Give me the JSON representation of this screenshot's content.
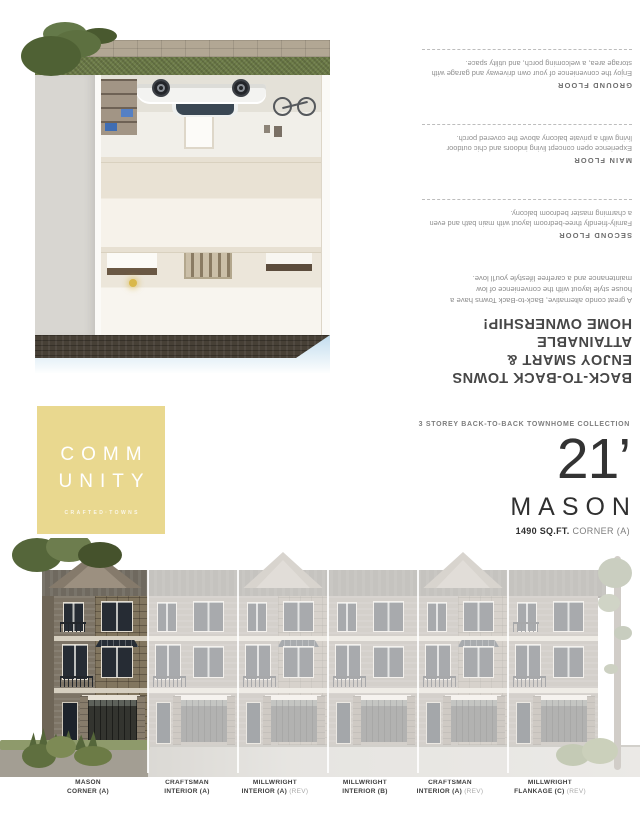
{
  "brochure": {
    "headline_lines": [
      "BACK-TO-BACK TOWNS",
      "ENJOY SMART & ATTAINABLE",
      "HOME OWNERSHIP!"
    ],
    "intro": "A great condo alternative, Back-to-Back Towns have a house style layout with the convenience of low maintenance and a carefree lifestyle you'll love.",
    "floors": [
      {
        "label": "SECOND FLOOR",
        "description": "Family-friendly three-bedroom layout with main bath and even a charming master bedroom balcony."
      },
      {
        "label": "MAIN FLOOR",
        "description": "Experience open concept living indoors and chic outdoor living with a private balcony above the covered porch."
      },
      {
        "label": "GROUND FLOOR",
        "description": "Enjoy the convenience of your own driveway and garage with storage area, a welcoming porch, and utility space."
      }
    ]
  },
  "brand": {
    "logo_line1": "COMM",
    "logo_line2": "UNITY",
    "tagline": "CRAFTED·TOWNS",
    "logo_background": "#e9d88f"
  },
  "plan": {
    "collection": "3 STOREY BACK-TO-BACK TOWNHOME COLLECTION",
    "frontage": "21’",
    "name": "MASON",
    "area": "1490 SQ.FT.",
    "unit_type": "CORNER (A)"
  },
  "elevation_units": [
    {
      "name": "MASON",
      "spec": "CORNER (A)",
      "rev": ""
    },
    {
      "name": "CRAFTSMAN",
      "spec": "INTERIOR (A)",
      "rev": ""
    },
    {
      "name": "MILLWRIGHT",
      "spec": "INTERIOR (A)",
      "rev": "(REV)"
    },
    {
      "name": "MILLWRIGHT",
      "spec": "INTERIOR (B)",
      "rev": ""
    },
    {
      "name": "CRAFTSMAN",
      "spec": "INTERIOR (A)",
      "rev": "(REV)"
    },
    {
      "name": "MILLWRIGHT",
      "spec": "FLANKAGE (C)",
      "rev": "(REV)"
    }
  ],
  "colors": {
    "brand_yellow": "#e9d88f",
    "text_dark": "#474747",
    "text_gray": "#8b8b8b"
  }
}
